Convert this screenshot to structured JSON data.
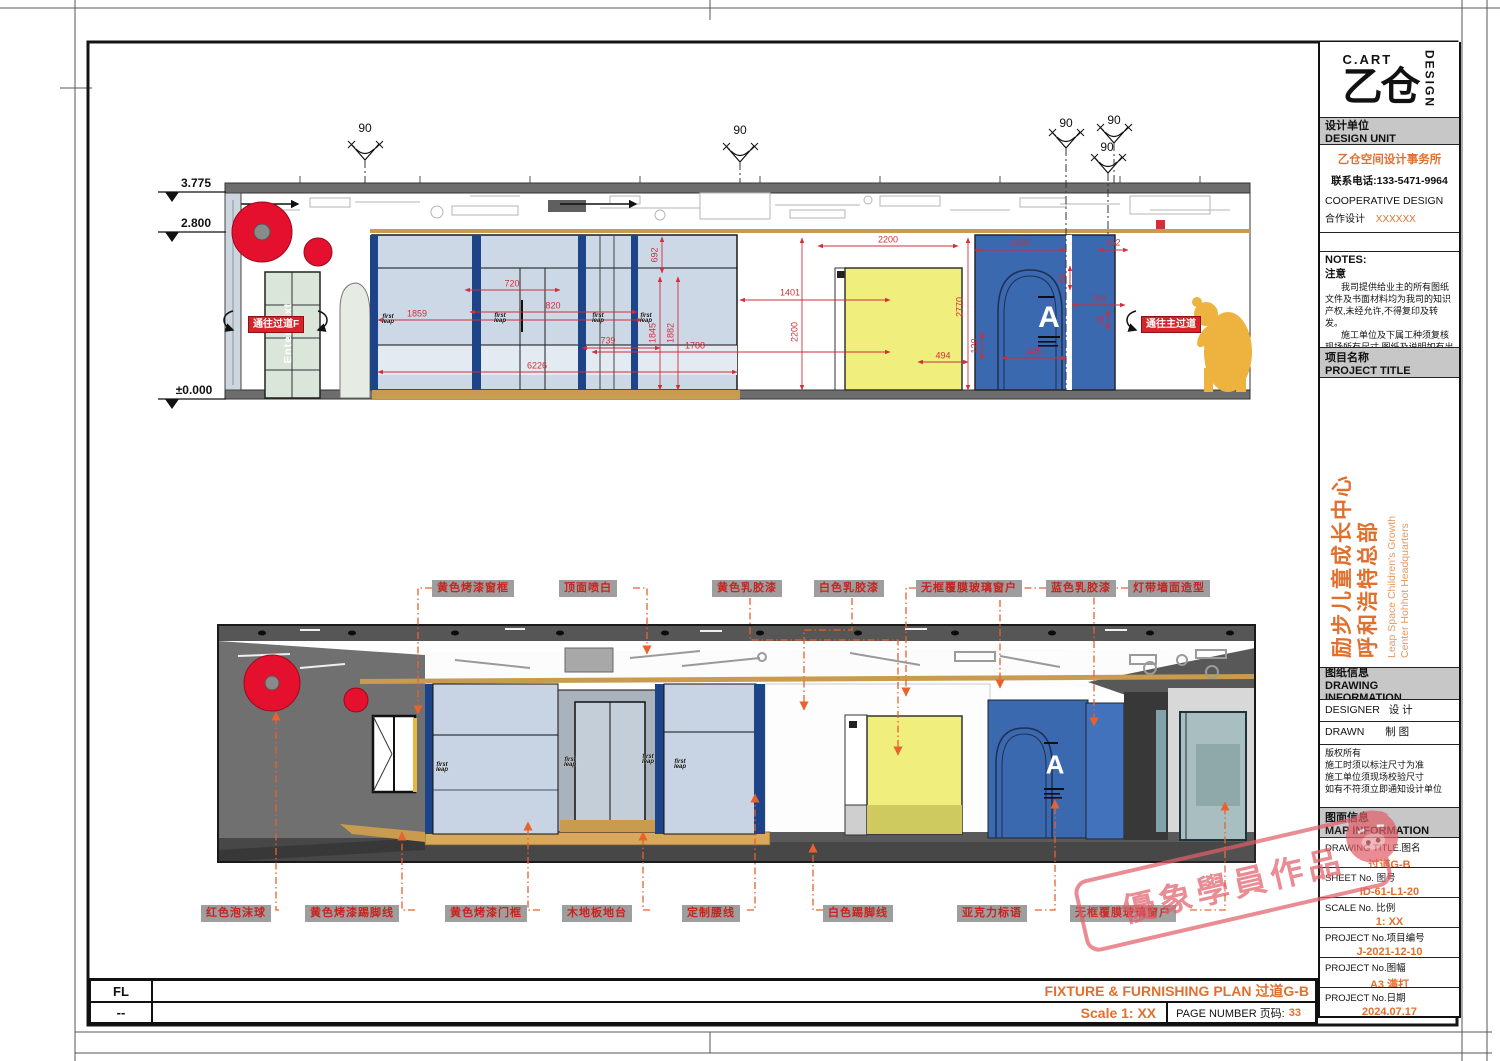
{
  "title_block": {
    "logo": {
      "brand_top": "C.ART",
      "glyph": "乙仓",
      "brand_side": "DESIGN"
    },
    "design_unit_cn": "设计单位",
    "design_unit_en": "DESIGN UNIT",
    "company": "乙仓空间设计事务所",
    "phone": "联系电话:133-5471-9964",
    "coop_en": "COOPERATIVE DESIGN",
    "coop_cn": "合作设计",
    "coop_value": "XXXXXX",
    "notes_en": "NOTES:",
    "notes_cn": "注意",
    "notes_p1": "我司提供给业主的所有图纸文件及书面材料均为我司的知识产权,未经允许,不得复印及转发。",
    "notes_p2": "施工单位及下属工种须复核现场所有尺寸,图纸及说明如有出入应及时报告。",
    "project_label_cn": "项目名称",
    "project_label_en": "PROJECT TITLE",
    "project_cn1": "励步儿童成长中心",
    "project_cn2": "呼和浩特总部",
    "project_en1": "Leap Space Children's Growth",
    "project_en2": "Center Hohhot Headquarters",
    "drawing_info_cn": "图纸信息",
    "drawing_info_en": "DRAWING INFORMATION",
    "designer": "DESIGNER",
    "designer_cn": "设  计",
    "drawn": "DRAWN",
    "drawn_cn": "制  图",
    "copyright": [
      "版权所有",
      "施工时须以标注尺寸为准",
      "施工单位须现场校验尺寸",
      "如有不符须立即通知设计单位"
    ],
    "map_info_cn": "图面信息",
    "map_info_en": "MAP INFORMATION",
    "rows": [
      {
        "label": "DRAWING TITLE.图名",
        "value": "过道G-B"
      },
      {
        "label": "SHEET No. 图号",
        "value": "ID-61-L1-20"
      },
      {
        "label": "SCALE No. 比例",
        "value": "1:  XX"
      },
      {
        "label": "PROJECT No.项目编号",
        "value": "J-2021-12-10"
      },
      {
        "label": "PROJECT No.图幅",
        "value": "A3 满打"
      },
      {
        "label": "PROJECT No.日期",
        "value": "2024.07.17"
      }
    ]
  },
  "footer": {
    "row1_left": "FL",
    "row1_title": "FIXTURE & FURNISHING PLAN 过道G-B",
    "row2_left": "--",
    "scale": "Scale 1:  XX",
    "page_label": "PAGE NUMBER 页码:",
    "page": "33"
  },
  "annotations": {
    "top": [
      {
        "t": "黄色烤漆窗框",
        "x": 432,
        "y": 580
      },
      {
        "t": "顶面喷白",
        "x": 559,
        "y": 580
      },
      {
        "t": "黄色乳胶漆",
        "x": 712,
        "y": 580
      },
      {
        "t": "白色乳胶漆",
        "x": 814,
        "y": 580
      },
      {
        "t": "无框覆膜玻璃窗户",
        "x": 916,
        "y": 580
      },
      {
        "t": "蓝色乳胶漆",
        "x": 1046,
        "y": 580
      },
      {
        "t": "灯带墙面造型",
        "x": 1128,
        "y": 580
      }
    ],
    "bottom": [
      {
        "t": "红色泡沫球",
        "x": 201,
        "y": 905
      },
      {
        "t": "黄色烤漆踢脚线",
        "x": 305,
        "y": 905
      },
      {
        "t": "黄色烤漆门框",
        "x": 445,
        "y": 905
      },
      {
        "t": "木地板地台",
        "x": 562,
        "y": 905
      },
      {
        "t": "定制腰线",
        "x": 682,
        "y": 905
      },
      {
        "t": "白色踢脚线",
        "x": 823,
        "y": 905
      },
      {
        "t": "亚克力标语",
        "x": 957,
        "y": 905
      },
      {
        "t": "无框覆膜玻璃窗户",
        "x": 1070,
        "y": 905
      }
    ]
  },
  "elevation": {
    "levels": [
      {
        "t": "3.775",
        "x": 196,
        "y": 189
      },
      {
        "t": "2.800",
        "x": 196,
        "y": 229
      },
      {
        "t": "±0.000",
        "x": 194,
        "y": 396
      }
    ],
    "angles": [
      {
        "t": "90",
        "x": 365,
        "y": 128
      },
      {
        "t": "90",
        "x": 740,
        "y": 130
      },
      {
        "t": "90",
        "x": 1066,
        "y": 123
      },
      {
        "t": "90",
        "x": 1114,
        "y": 120
      },
      {
        "t": "90",
        "x": 1107,
        "y": 147
      }
    ],
    "dims": [
      {
        "v": "720",
        "x": 512,
        "y": 284,
        "r": 0
      },
      {
        "v": "1859",
        "x": 417,
        "y": 314,
        "r": 0
      },
      {
        "v": "820",
        "x": 553,
        "y": 306,
        "r": 0
      },
      {
        "v": "739",
        "x": 608,
        "y": 341,
        "r": 0
      },
      {
        "v": "6226",
        "x": 537,
        "y": 366,
        "r": 0
      },
      {
        "v": "692",
        "x": 655,
        "y": 255,
        "r": 1
      },
      {
        "v": "1845",
        "x": 653,
        "y": 333,
        "r": 1
      },
      {
        "v": "1882",
        "x": 671,
        "y": 333,
        "r": 1
      },
      {
        "v": "1788",
        "x": 695,
        "y": 346,
        "r": 0
      },
      {
        "v": "1401",
        "x": 790,
        "y": 293,
        "r": 0
      },
      {
        "v": "2200",
        "x": 795,
        "y": 332,
        "r": 1
      },
      {
        "v": "2200",
        "x": 888,
        "y": 240,
        "r": 0
      },
      {
        "v": "2770",
        "x": 960,
        "y": 307,
        "r": 1
      },
      {
        "v": "494",
        "x": 943,
        "y": 356,
        "r": 0
      },
      {
        "v": "120",
        "x": 975,
        "y": 346,
        "r": 1
      },
      {
        "v": "1505",
        "x": 1020,
        "y": 243,
        "r": 0
      },
      {
        "v": "152",
        "x": 1113,
        "y": 243,
        "r": 0
      },
      {
        "v": "50",
        "x": 1063,
        "y": 278,
        "r": 1
      },
      {
        "v": "700",
        "x": 1098,
        "y": 299,
        "r": 0
      },
      {
        "v": "25",
        "x": 1101,
        "y": 320,
        "r": 1
      },
      {
        "v": "445",
        "x": 1034,
        "y": 352,
        "r": 0
      }
    ],
    "badge_left": "通往过道F",
    "badge_right": "通往主过道",
    "enter_text": "Enter text",
    "letter_a": "A"
  },
  "drawing": {
    "logo_lines": [
      "first",
      "leap"
    ],
    "elev_logos": [
      {
        "x": 388,
        "y": 320
      },
      {
        "x": 500,
        "y": 319
      },
      {
        "x": 598,
        "y": 319
      },
      {
        "x": 646,
        "y": 319
      }
    ],
    "persp_logos": [
      {
        "x": 442,
        "y": 768
      },
      {
        "x": 570,
        "y": 763
      },
      {
        "x": 648,
        "y": 760
      },
      {
        "x": 680,
        "y": 765
      }
    ]
  },
  "watermark": "優象學員作品",
  "colors": {
    "accent_orange": "#e0702f",
    "annotation_red": "#c8231f",
    "dim_red": "#cf2f3a",
    "leader_orange": "#e8622d",
    "wall_blue": "#3a69b0",
    "mullion_blue": "#1d4488",
    "panel_yellow": "#f0ee7c",
    "sphere_red": "#e50f2e",
    "wood_tan": "#c99b4f"
  }
}
